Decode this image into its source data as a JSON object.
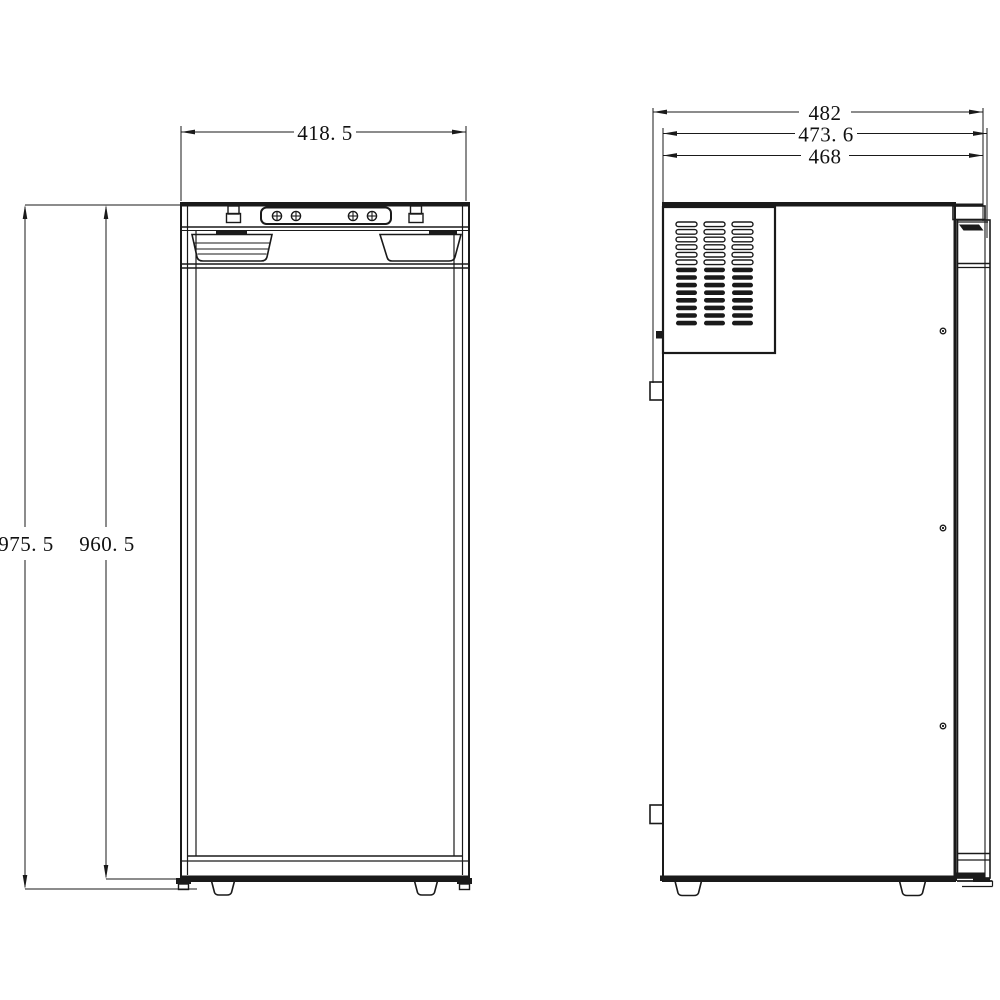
{
  "dimensions": {
    "front_width": "418. 5",
    "front_height_overall": "975. 5",
    "front_height_cabinet": "960. 5",
    "side_depth_overall": "482",
    "side_depth_with_door": "473. 6",
    "side_depth_body": "468"
  },
  "front_view": {
    "screw_count": 4
  },
  "side_view": {
    "vent_grid": {
      "columns": 3,
      "rows": 14,
      "open_rows": 6
    },
    "screw_count": 3
  },
  "colors": {
    "line": "#1a1a1a",
    "background": "#ffffff"
  }
}
